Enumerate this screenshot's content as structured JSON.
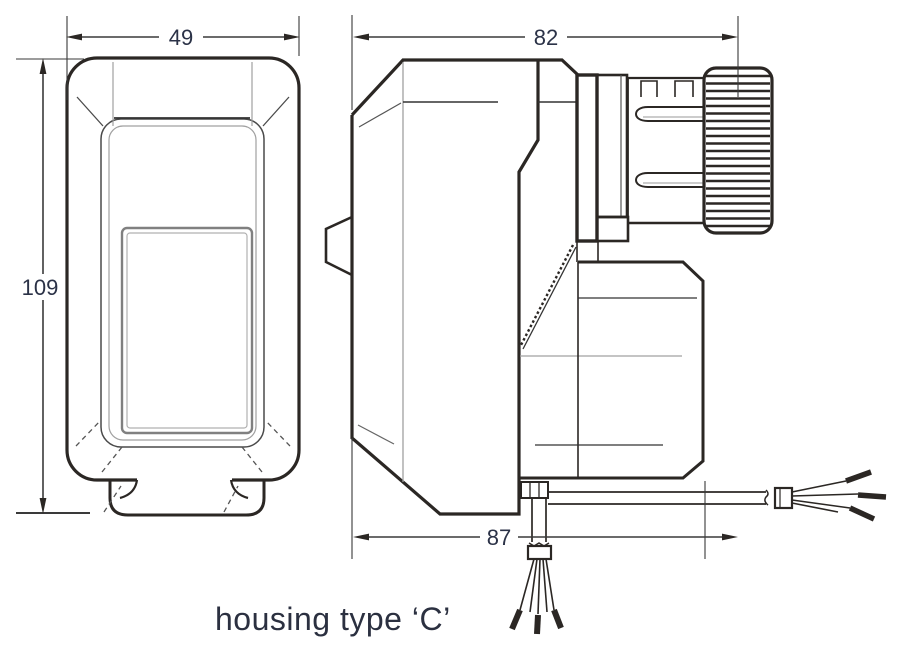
{
  "drawing": {
    "caption": "housing type ‘C’",
    "dimensions": {
      "front_width": "49",
      "front_height": "109",
      "side_depth_total": "82",
      "side_depth_body": "87"
    },
    "colors": {
      "line": "#2b2724",
      "grey_line": "#a0a0a0",
      "text": "#2b3247"
    }
  }
}
